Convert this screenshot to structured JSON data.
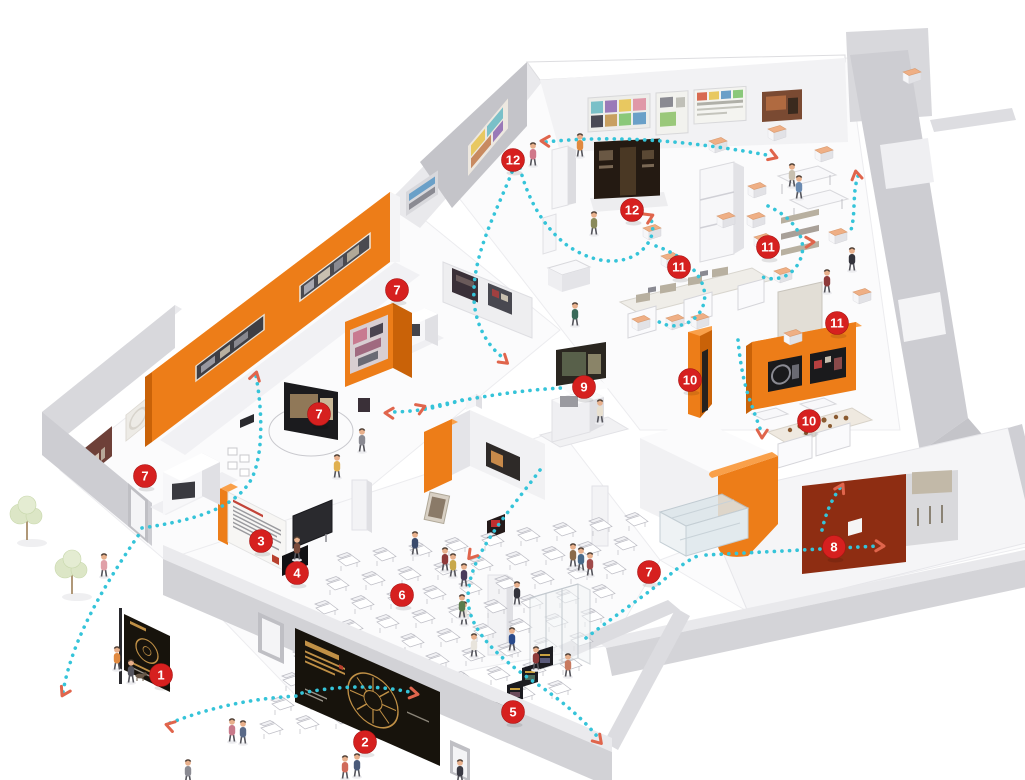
{
  "scene": {
    "description": "isometric-exhibition-floorplan",
    "colors": {
      "accent_orange": "#ED7D18",
      "orange_dark": "#C96208",
      "orange_light": "#F9A04A",
      "marker_red": "#D6201F",
      "route_cyan": "#35C4D9",
      "arrow_coral": "#E0654C",
      "wall_gray": "#CDCDD2",
      "wall_gray_light": "#E6E6EA",
      "wall_gray_dark": "#B5B5BB",
      "banner_black": "#17130C",
      "banner_gold": "#C09046",
      "table_peach": "#EFAF85",
      "maroon_panel": "#8E2D12",
      "glass_blue": "#DCE6EA",
      "tree_green": "#DCE6C6",
      "floor_white": "#FBFBFC"
    }
  },
  "markers": [
    {
      "n": "1",
      "x": 161,
      "y": 675
    },
    {
      "n": "2",
      "x": 365,
      "y": 742
    },
    {
      "n": "3",
      "x": 261,
      "y": 541
    },
    {
      "n": "4",
      "x": 297,
      "y": 573
    },
    {
      "n": "5",
      "x": 513,
      "y": 712
    },
    {
      "n": "6",
      "x": 402,
      "y": 595
    },
    {
      "n": "7",
      "x": 145,
      "y": 476
    },
    {
      "n": "7",
      "x": 319,
      "y": 414
    },
    {
      "n": "7",
      "x": 397,
      "y": 290
    },
    {
      "n": "7",
      "x": 649,
      "y": 572
    },
    {
      "n": "8",
      "x": 834,
      "y": 547
    },
    {
      "n": "9",
      "x": 584,
      "y": 387
    },
    {
      "n": "10",
      "x": 690,
      "y": 380
    },
    {
      "n": "10",
      "x": 809,
      "y": 421
    },
    {
      "n": "11",
      "x": 679,
      "y": 267
    },
    {
      "n": "11",
      "x": 768,
      "y": 247
    },
    {
      "n": "11",
      "x": 837,
      "y": 323
    },
    {
      "n": "12",
      "x": 513,
      "y": 160
    },
    {
      "n": "12",
      "x": 632,
      "y": 210
    }
  ],
  "routes": [
    {
      "d": "M 63,692 C 72,640 102,588 142,530"
    },
    {
      "d": "M 170,723 C 214,706 256,698 298,696"
    },
    {
      "d": "M 142,528 C 196,520 236,508 252,478 C 264,452 262,408 256,376"
    },
    {
      "d": "M 462,400 C 438,408 414,412 390,412"
    },
    {
      "d": "M 425,408 C 470,398 520,390 562,388"
    },
    {
      "d": "M 512,172 C 498,208 476,248 474,288 C 472,320 486,346 506,360"
    },
    {
      "d": "M 520,168 C 528,200 544,228 568,246 C 598,266 624,264 640,252 C 652,242 656,228 650,218"
    },
    {
      "d": "M 546,142 C 618,134 698,142 772,156"
    },
    {
      "d": "M 656,246 C 696,260 714,290 700,312 C 690,327 670,330 656,320"
    },
    {
      "d": "M 768,206 C 798,220 810,244 798,264 C 790,278 774,282 760,276"
    },
    {
      "d": "M 858,176 C 852,194 856,212 851,230"
    },
    {
      "d": "M 540,470 C 506,516 468,556 468,598 C 468,630 498,658 540,686 C 566,704 586,722 600,740"
    },
    {
      "d": "M 586,638 C 620,612 650,592 666,578 C 682,564 692,558 700,555"
    },
    {
      "d": "M 706,555 L 878,546"
    },
    {
      "d": "M 822,530 C 826,512 832,499 840,488"
    },
    {
      "d": "M 302,693 C 342,685 380,685 414,693"
    },
    {
      "d": "M 738,340 C 740,362 744,386 752,406 C 756,418 760,428 762,434"
    }
  ],
  "arrows": [
    {
      "x": 63,
      "y": 694,
      "r": 118
    },
    {
      "x": 168,
      "y": 725,
      "r": 196
    },
    {
      "x": 256,
      "y": 374,
      "r": -75
    },
    {
      "x": 387,
      "y": 413,
      "r": 182
    },
    {
      "x": 423,
      "y": 407,
      "r": -22
    },
    {
      "x": 543,
      "y": 141,
      "r": 183
    },
    {
      "x": 775,
      "y": 157,
      "r": 20
    },
    {
      "x": 651,
      "y": 216,
      "r": -25
    },
    {
      "x": 812,
      "y": 242,
      "r": -2
    },
    {
      "x": 882,
      "y": 546,
      "r": 2
    },
    {
      "x": 856,
      "y": 173,
      "r": -100
    },
    {
      "x": 600,
      "y": 742,
      "r": 48
    },
    {
      "x": 842,
      "y": 486,
      "r": -62
    },
    {
      "x": 416,
      "y": 694,
      "r": 10
    },
    {
      "x": 762,
      "y": 436,
      "r": 92
    },
    {
      "x": 470,
      "y": 557,
      "r": 130
    },
    {
      "x": 506,
      "y": 362,
      "r": 40
    }
  ],
  "chairs": {
    "origin": [
      338,
      560
    ],
    "u": [
      36,
      -5
    ],
    "v": [
      -11,
      24
    ],
    "cols": 9,
    "rows": 8
  },
  "stools": [
    [
      718,
      141
    ],
    [
      777,
      129
    ],
    [
      824,
      150
    ],
    [
      912,
      72
    ],
    [
      757,
      186
    ],
    [
      756,
      216
    ],
    [
      726,
      216
    ],
    [
      670,
      256
    ],
    [
      652,
      228
    ],
    [
      641,
      319
    ],
    [
      675,
      318
    ],
    [
      700,
      317
    ],
    [
      783,
      271
    ],
    [
      793,
      333
    ],
    [
      763,
      237
    ],
    [
      838,
      232
    ],
    [
      862,
      292
    ]
  ],
  "people": [
    [
      117,
      655,
      "#E0893F"
    ],
    [
      131,
      668,
      "#55555F"
    ],
    [
      232,
      727,
      "#C87A8A"
    ],
    [
      243,
      729,
      "#5A6A88"
    ],
    [
      345,
      764,
      "#D06A5A"
    ],
    [
      357,
      762,
      "#4A5A7A"
    ],
    [
      104,
      562,
      "#E0A0A8"
    ],
    [
      297,
      545,
      "#7A4A3A"
    ],
    [
      362,
      437,
      "#8A8A92"
    ],
    [
      337,
      463,
      "#E0B050"
    ],
    [
      415,
      540,
      "#3A4A6B"
    ],
    [
      445,
      556,
      "#8E3A3A"
    ],
    [
      453,
      562,
      "#C8A84A"
    ],
    [
      464,
      572,
      "#4A3A5A"
    ],
    [
      464,
      610,
      "#E6E2DA"
    ],
    [
      517,
      590,
      "#33333B"
    ],
    [
      512,
      636,
      "#2A4A8A"
    ],
    [
      474,
      642,
      "#E8E4DC"
    ],
    [
      462,
      603,
      "#5A7A4A"
    ],
    [
      536,
      655,
      "#8E3A3A"
    ],
    [
      568,
      662,
      "#C87A60"
    ],
    [
      573,
      552,
      "#8A6A4A"
    ],
    [
      581,
      556,
      "#4A6A8A"
    ],
    [
      590,
      561,
      "#A04A4A"
    ],
    [
      533,
      151,
      "#D0788A"
    ],
    [
      580,
      142,
      "#E0893F"
    ],
    [
      594,
      220,
      "#8A8A5A"
    ],
    [
      575,
      311,
      "#3A6A5A"
    ],
    [
      600,
      408,
      "#E8E0D0"
    ],
    [
      827,
      278,
      "#8E3A3A"
    ],
    [
      792,
      172,
      "#C8C0B0"
    ],
    [
      799,
      184,
      "#6A8AB0"
    ],
    [
      852,
      256,
      "#33333B"
    ],
    [
      460,
      768,
      "#3A3A44"
    ],
    [
      188,
      768,
      "#8A8A92"
    ]
  ],
  "dog": {
    "x": 140,
    "y": 676
  },
  "trees": [
    [
      27,
      540
    ],
    [
      72,
      594
    ]
  ]
}
